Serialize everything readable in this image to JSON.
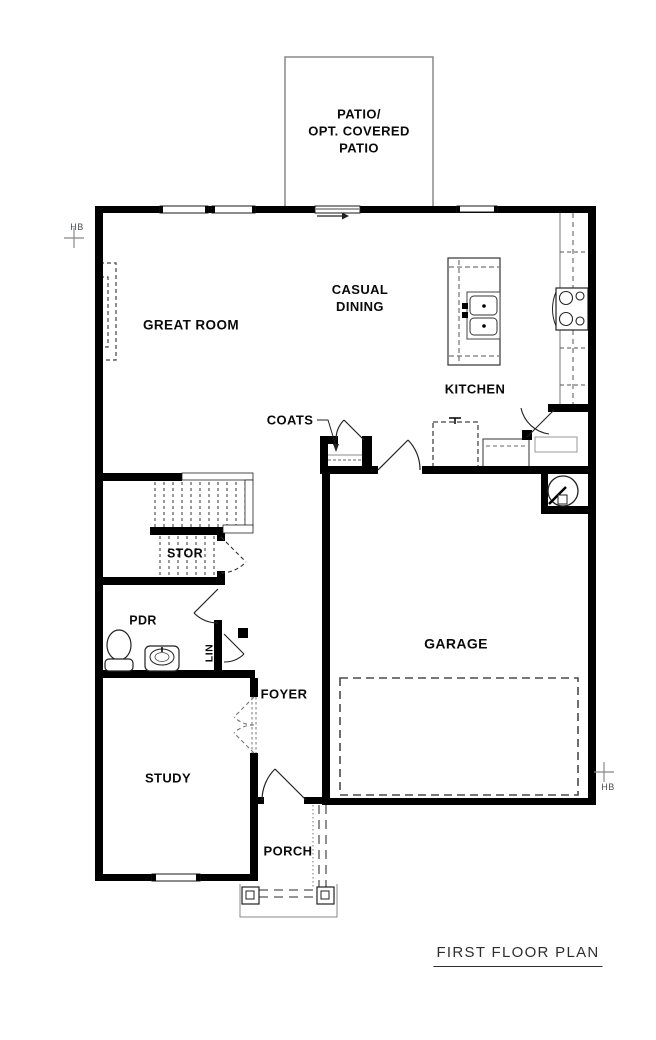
{
  "title": {
    "label": "FIRST FLOOR PLAN"
  },
  "annotations": {
    "hb_left": "HB",
    "hb_right": "HB"
  },
  "rooms": {
    "patio": {
      "line1": "PATIO/",
      "line2": "OPT. COVERED",
      "line3": "PATIO"
    },
    "great_room": {
      "label": "GREAT ROOM"
    },
    "casual_dining": {
      "line1": "CASUAL",
      "line2": "DINING"
    },
    "kitchen": {
      "label": "KITCHEN"
    },
    "coats": {
      "label": "COATS"
    },
    "stor": {
      "label": "STOR"
    },
    "pdr": {
      "label": "PDR"
    },
    "lin": {
      "label": "LIN"
    },
    "foyer": {
      "label": "FOYER"
    },
    "garage": {
      "label": "GARAGE"
    },
    "study": {
      "label": "STUDY"
    },
    "porch": {
      "label": "PORCH"
    }
  },
  "colors": {
    "wall": "#000000",
    "line": "#222222",
    "thin_gray": "#8a8a8a",
    "dash": "#4a4a4a",
    "label": "#0a0a0a",
    "title": "#2e2e2e",
    "hb": "#474f56"
  }
}
